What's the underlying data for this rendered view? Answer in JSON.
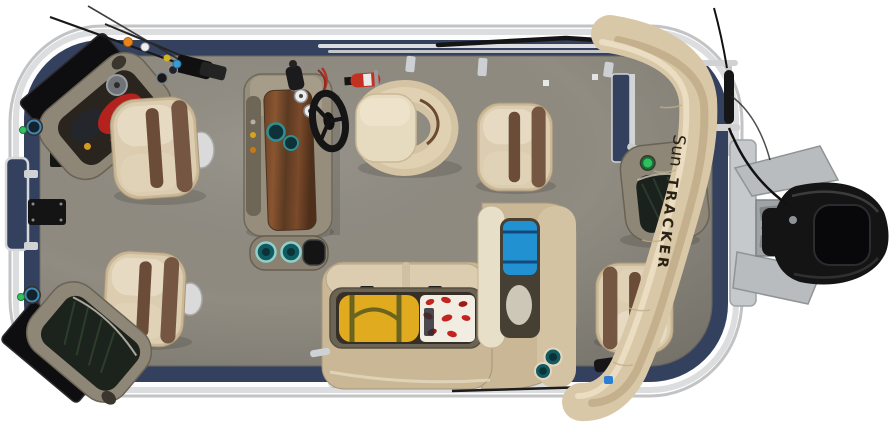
{
  "photo": {
    "subject": "Overhead view of a SUN TRACKER pontoon fishing boat",
    "background_color": "#ffffff"
  },
  "brand": {
    "script": "Sun",
    "block": "TRACKER"
  },
  "palette": {
    "deck_gray": "#8f8b81",
    "fence_navy": "#33415f",
    "rail_silver": "#dcdddf",
    "console_taupe": "#8e8677",
    "seat_tan": "#d8c9ac",
    "seat_trim_brown": "#6b4c38",
    "bimini_tan": "#d9c8a7",
    "motor_black": "#141414",
    "livewell_green": "#1c231c",
    "cooler_blue": "#2191d2",
    "duffel_yellow": "#e0ab1f",
    "life_vest_red": "#c32420",
    "extinguisher_red": "#c23122",
    "cupholder_teal": "#2e8f94",
    "nav_light_green": "#2fbf5f"
  }
}
